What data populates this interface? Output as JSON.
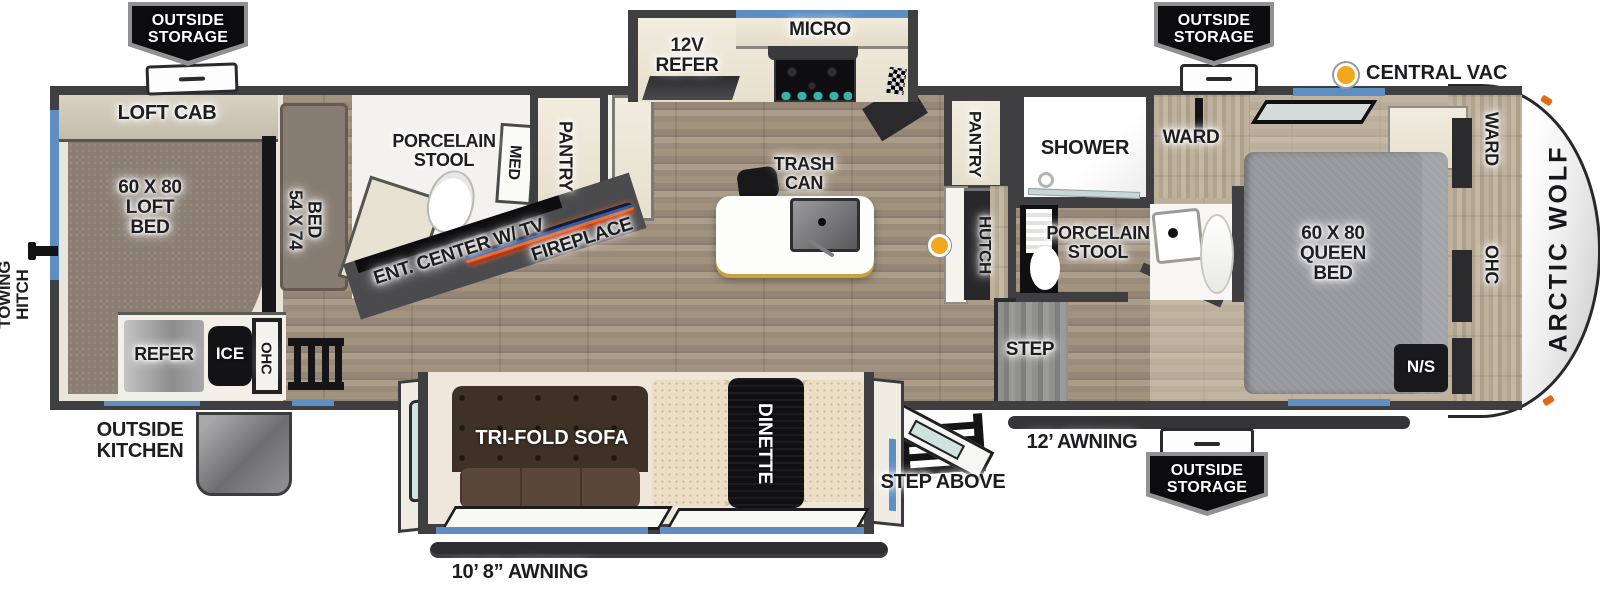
{
  "legend": {
    "central_vac": "CENTRAL VAC"
  },
  "exterior": {
    "outside_storage": "OUTSIDE\nSTORAGE",
    "outside_kitchen": "OUTSIDE\nKITCHEN",
    "towing_hitch": "TOWING\nHITCH",
    "step_above": "STEP ABOVE",
    "awning_door_side": "12’ AWNING",
    "awning_slide_side": "10’ 8” AWNING",
    "brand": "ARCTIC WOLF"
  },
  "rooms": {
    "loft": {
      "loft_cab": "LOFT CAB",
      "loft_bed": "60 X 80\nLOFT\nBED",
      "bed_54x74": "54 X 74\nBED",
      "refer": "REFER",
      "ice": "ICE",
      "ohc": "OHC"
    },
    "mid_bath": {
      "porcelain_stool": "PORCELAIN\nSTOOL",
      "med": "MED",
      "pantry": "PANTRY"
    },
    "living": {
      "ent_center": "ENT. CENTER W/ TV",
      "fireplace": "FIREPLACE",
      "tri_fold_sofa": "TRI-FOLD SOFA",
      "dinette": "DINETTE"
    },
    "kitchen": {
      "refer_12v": "12V\nREFER",
      "micro": "MICRO",
      "trash_can": "TRASH\nCAN",
      "pantry": "PANTRY",
      "hutch": "HUTCH",
      "step": "STEP"
    },
    "main_bath": {
      "shower": "SHOWER",
      "ward": "WARD",
      "porcelain_stool": "PORCELAIN\nSTOOL"
    },
    "bedroom": {
      "queen_bed": "60 X 80\nQUEEN\nBED",
      "ward": "WARD",
      "ohc": "OHC",
      "nightstand": "N/S"
    }
  },
  "colors": {
    "wall": "#3f3f42",
    "window_accent": "#5d8fc2",
    "vac_dot": "#f3a71b",
    "fireplace_orange": "#e8641f",
    "fireplace_blue": "#2b57a8"
  }
}
